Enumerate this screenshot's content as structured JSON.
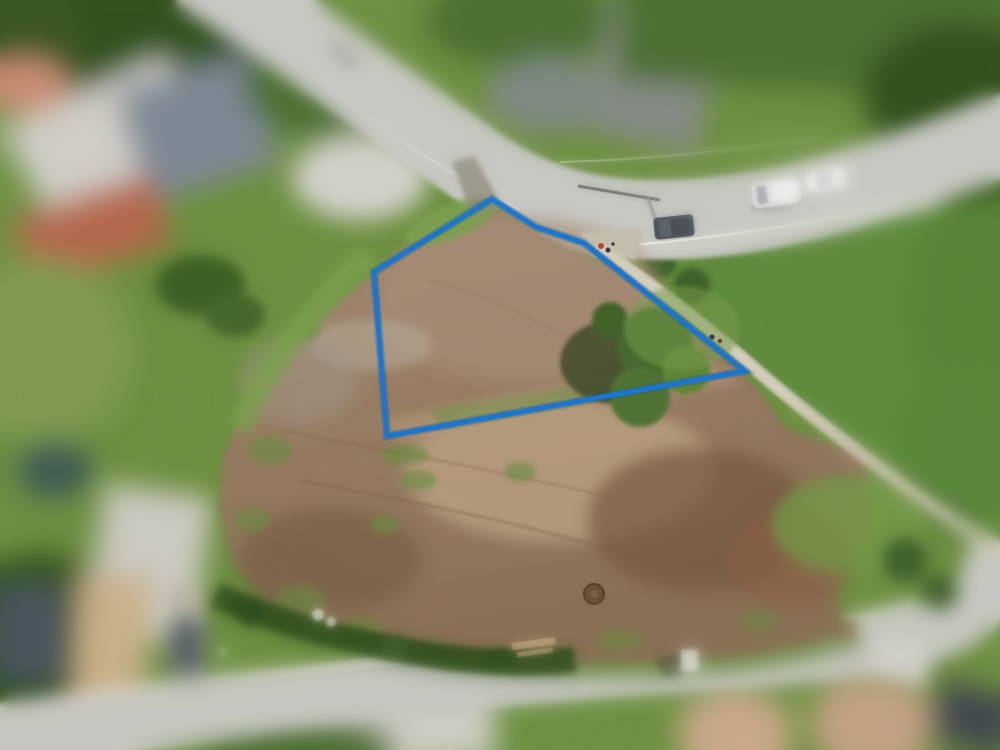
{
  "scene": {
    "description": "Aerial drone photograph of a cleared construction plot in a residential area, with a blue surveyed-boundary polygon drawn over the terrain",
    "focus": "tilt-shift: plot sharp, surrounding houses/gardens blurred"
  },
  "annotation": {
    "name": "plot-boundary",
    "points": "492,199 536,227 584,243 745,371 387,436 374,272",
    "stroke_width": "5"
  },
  "palette": {
    "annotation": "#1c76cd",
    "annotation-glow": "#155a9e",
    "grass-base": "#6f9043",
    "grass-bright": "#7ca04f",
    "grass-ne": "#5f8a3d",
    "tree-dark": "#33511f",
    "tree-mid": "#4d7030",
    "hedge": "#32501f",
    "dirt-top": "#a28a72",
    "dirt-bottom": "#8a7057",
    "dirt-sand": "#bba183",
    "dirt-dark": "#74593f",
    "road": "#c8c8c3",
    "road-lower": "#c6c6c0",
    "gravel-path": "#cdc7b4",
    "white-vehicle": "#f4f5f2",
    "dark-van": "#4a4f55"
  },
  "objects": {
    "vehicles": [
      {
        "label": "white van parked on upper road"
      },
      {
        "label": "white car parked on upper road"
      },
      {
        "label": "dark van parked on upper road"
      },
      {
        "label": "dark car at lower-right corner (blurred)"
      }
    ],
    "features": [
      {
        "label": "cleared dirt plot"
      },
      {
        "label": "gravel footpath along north-east boundary"
      },
      {
        "label": "tree cluster inside plot"
      },
      {
        "label": "hedge row with white flowers along lower road"
      },
      {
        "label": "manhole cover"
      },
      {
        "label": "white storage box"
      },
      {
        "label": "pedestrians at path entrance"
      },
      {
        "label": "pedestrians on footpath"
      }
    ]
  }
}
